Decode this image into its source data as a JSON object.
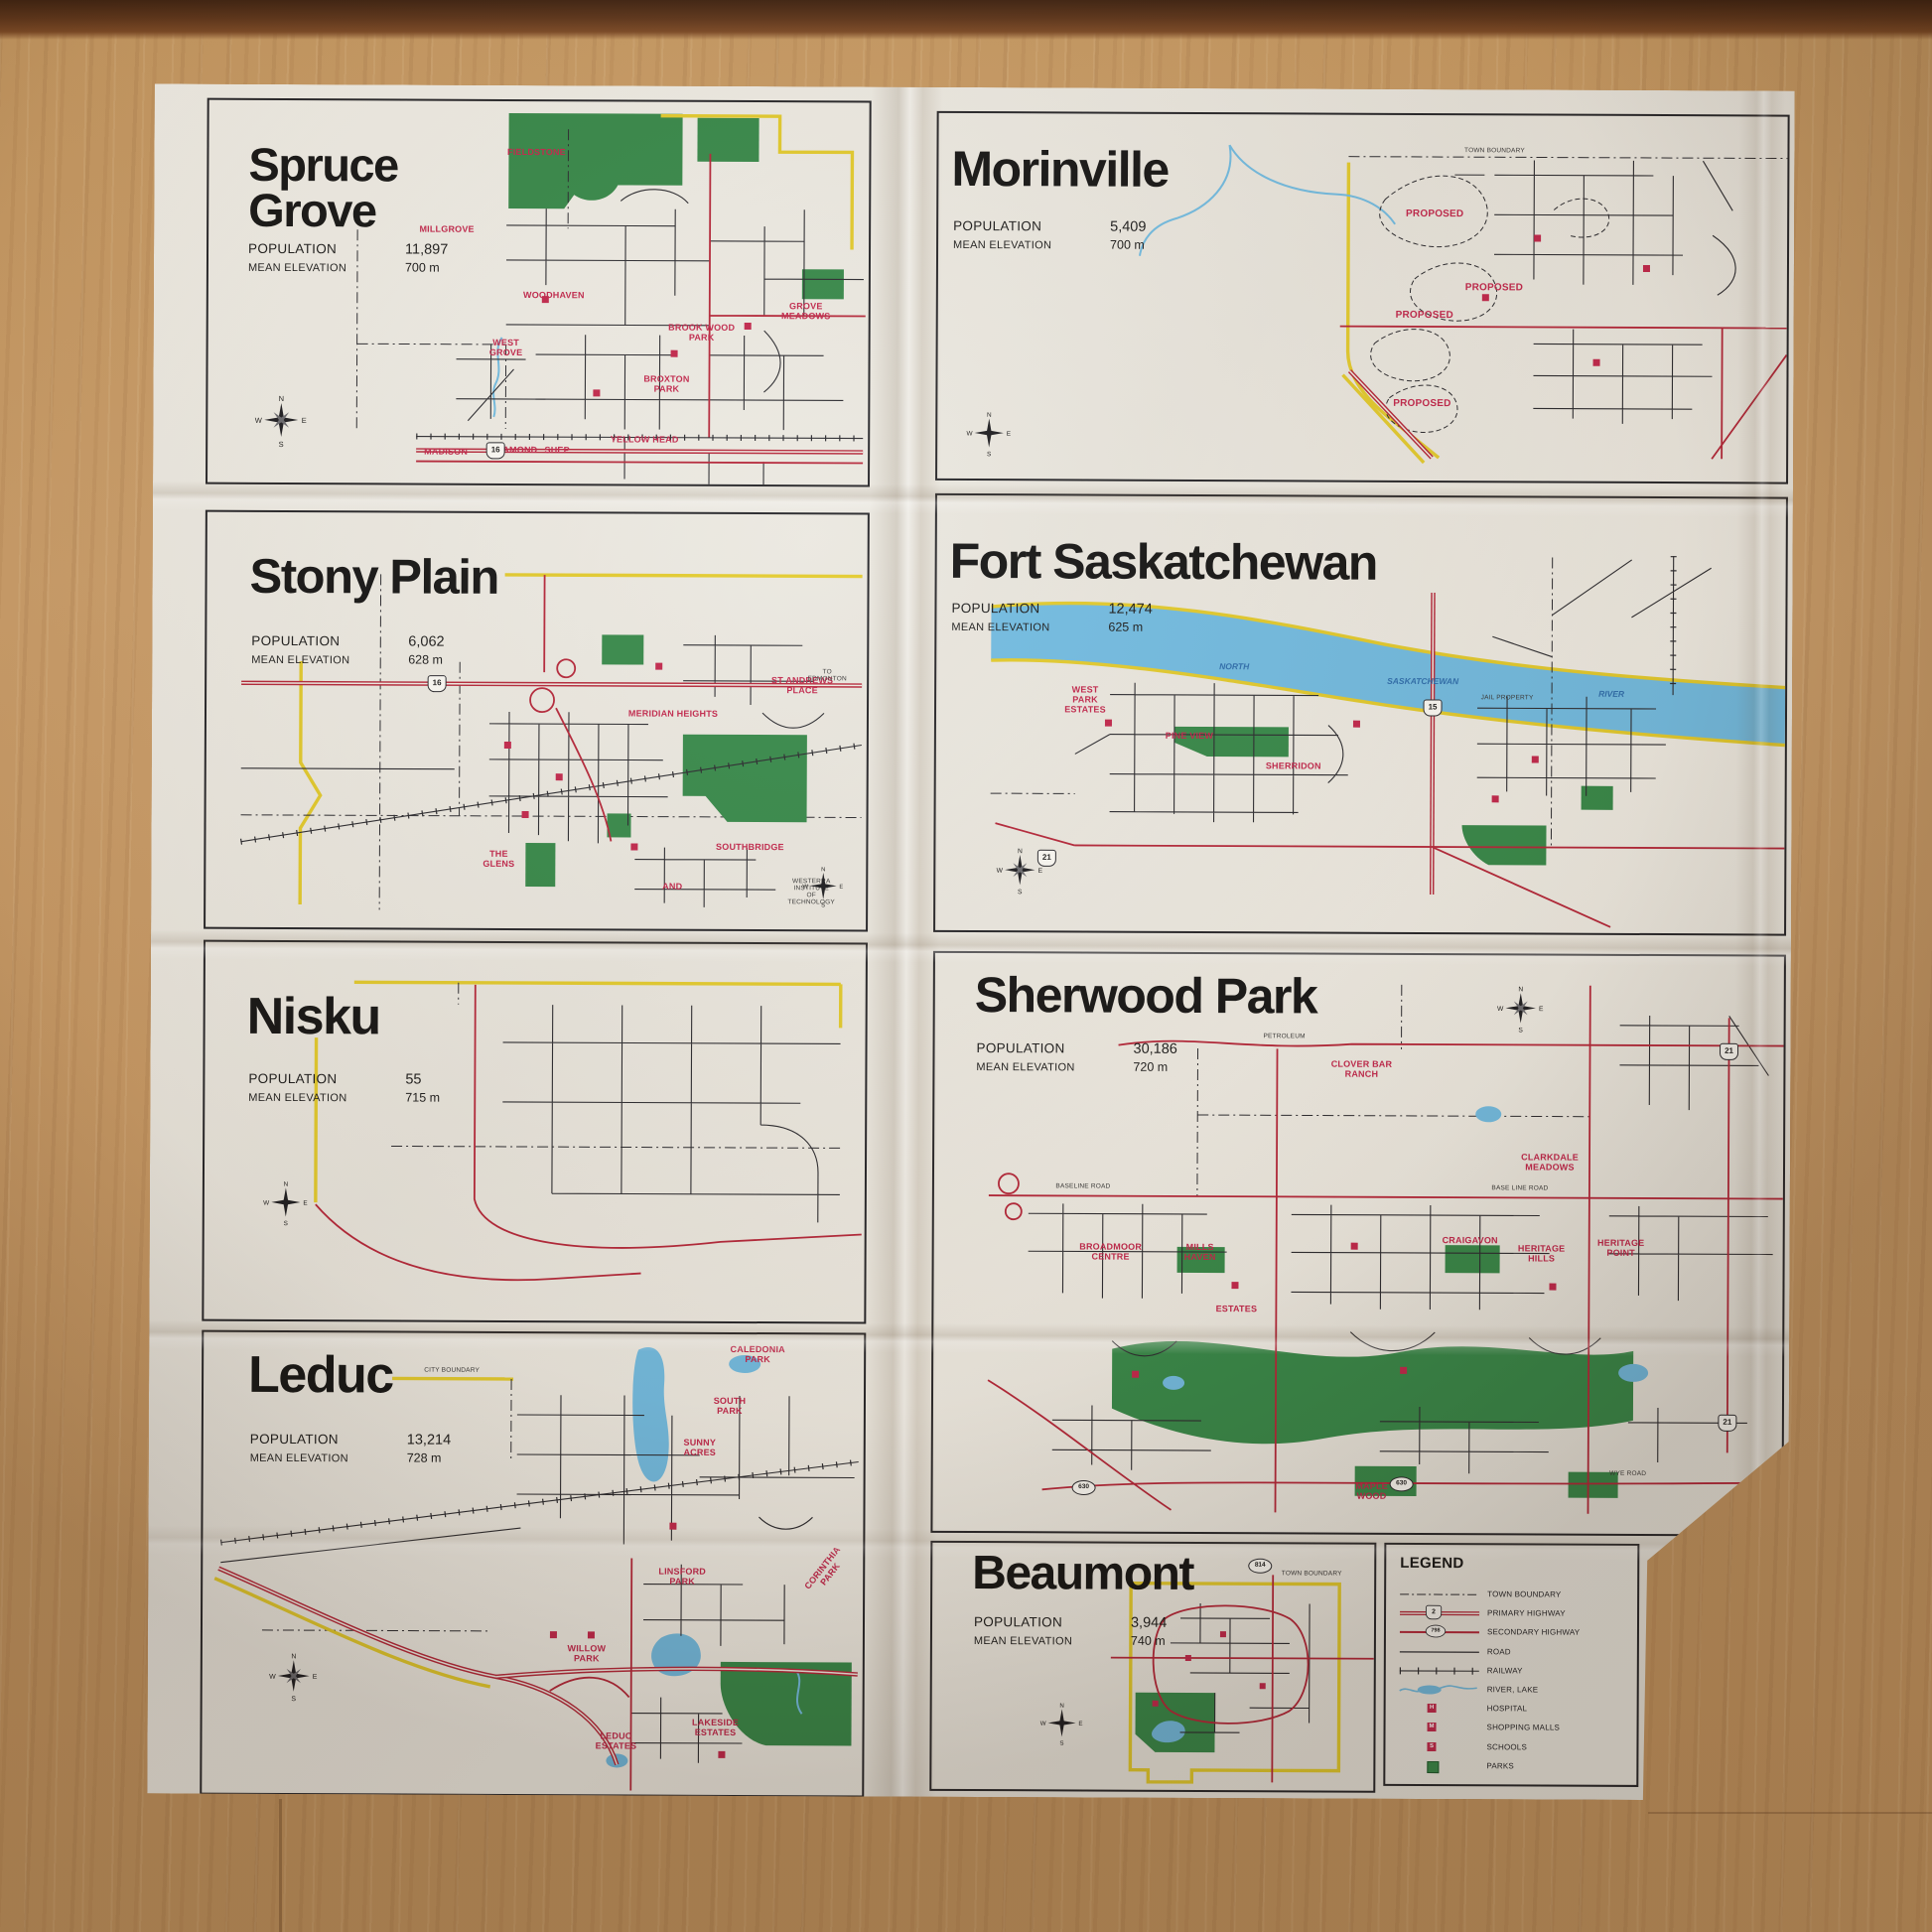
{
  "compass": {
    "n": "N",
    "e": "E",
    "s": "S",
    "w": "W"
  },
  "panels": {
    "spruce_grove": {
      "title": "Spruce Grove",
      "population_label": "POPULATION",
      "population": "11,897",
      "elevation_label": "MEAN ELEVATION",
      "elevation": "700 m",
      "shield": "16",
      "labels": {
        "fieldstone": "FIELDSTONE",
        "millgrove": "MILLGROVE",
        "woodhaven": "WOODHAVEN",
        "west_grove": "WEST\nGROVE",
        "brookwood_park": "BROOK WOOD\nPARK",
        "broxton_park": "BROXTON\nPARK",
        "grove_meadows": "GROVE\nMEADOWS",
        "madison": "MADISON",
        "diamond": "DIAMOND",
        "shep": "SHEP",
        "yellowhead": "YELLOW HEAD"
      }
    },
    "morinville": {
      "title": "Morinville",
      "population_label": "POPULATION",
      "population": "5,409",
      "elevation_label": "MEAN ELEVATION",
      "elevation": "700 m",
      "labels": {
        "proposed1": "PROPOSED",
        "proposed2": "PROPOSED",
        "proposed3": "PROPOSED",
        "proposed4": "PROPOSED",
        "town_boundary": "TOWN BOUNDARY"
      }
    },
    "stony_plain": {
      "title": "Stony Plain",
      "population_label": "POPULATION",
      "population": "6,062",
      "elevation_label": "MEAN ELEVATION",
      "elevation": "628 m",
      "shield": "16",
      "labels": {
        "st_andrews": "ST ANDREWS\nPLACE",
        "meridian_heights": "MERIDIAN HEIGHTS",
        "the_glens": "THE\nGLENS",
        "southbridge": "SOUTHBRIDGE",
        "and": "AND",
        "to_edmonton": "TO EDMONTON",
        "westerra": "WESTERRA INSTITUTE\nOF TECHNOLOGY"
      }
    },
    "fort_saskatchewan": {
      "title": "Fort Saskatchewan",
      "population_label": "POPULATION",
      "population": "12,474",
      "elevation_label": "MEAN ELEVATION",
      "elevation": "625 m",
      "shields": {
        "h15": "15",
        "h21": "21"
      },
      "labels": {
        "west_park": "WEST\nPARK\nESTATES",
        "pine_view": "PINE VIEW",
        "sherridon": "SHERRIDON",
        "river_north": "NORTH",
        "river_sask": "SASKATCHEWAN",
        "river_river": "RIVER",
        "jail": "JAIL PROPERTY"
      }
    },
    "nisku": {
      "title": "Nisku",
      "population_label": "POPULATION",
      "population": "55",
      "elevation_label": "MEAN ELEVATION",
      "elevation": "715 m"
    },
    "sherwood_park": {
      "title": "Sherwood Park",
      "population_label": "POPULATION",
      "population": "30,186",
      "elevation_label": "MEAN ELEVATION",
      "elevation": "720 m",
      "shields": {
        "h21a": "21",
        "h21b": "21",
        "h630a": "630",
        "h630b": "630"
      },
      "labels": {
        "clover_bar": "CLOVER BAR\nRANCH",
        "clarkdale": "CLARKDALE\nMEADOWS",
        "craigavon": "CRAIGAVON",
        "heritage_hills": "HERITAGE\nHILLS",
        "heritage_point": "HERITAGE\nPOINT",
        "broadmoor": "BROADMOOR\nCENTRE",
        "mills_haven": "MILLS\nHAVEN",
        "estates": "ESTATES",
        "maple_wood": "MAPLE\nWOOD",
        "baseline": "BASELINE ROAD",
        "base_line": "BASE LINE ROAD",
        "wye": "WYE ROAD",
        "petroleum": "PETROLEUM"
      }
    },
    "leduc": {
      "title": "Leduc",
      "population_label": "POPULATION",
      "population": "13,214",
      "elevation_label": "MEAN ELEVATION",
      "elevation": "728 m",
      "labels": {
        "caledonia": "CALEDONIA\nPARK",
        "south_park": "SOUTH\nPARK",
        "sunny_acres": "SUNNY\nACRES",
        "linsford": "LINSFORD\nPARK",
        "willow": "WILLOW\nPARK",
        "corinthia": "CORINTHIA PARK",
        "leduc_estates": "LEDUC\nESTATES",
        "lakeside": "LAKESIDE\nESTATES",
        "city_boundary": "CITY BOUNDARY"
      }
    },
    "beaumont": {
      "title": "Beaumont",
      "population_label": "POPULATION",
      "population": "3,944",
      "elevation_label": "MEAN ELEVATION",
      "elevation": "740 m",
      "shield": "814",
      "labels": {
        "town_boundary": "TOWN BOUNDARY"
      }
    }
  },
  "legend": {
    "title": "LEGEND",
    "items": [
      {
        "type": "boundary",
        "label": "TOWN BOUNDARY"
      },
      {
        "type": "primary",
        "label": "PRIMARY HIGHWAY",
        "badge": "2"
      },
      {
        "type": "secondary",
        "label": "SECONDARY HIGHWAY",
        "badge": "798"
      },
      {
        "type": "road",
        "label": "ROAD"
      },
      {
        "type": "railway",
        "label": "RAILWAY"
      },
      {
        "type": "river",
        "label": "RIVER, LAKE"
      },
      {
        "type": "hospital",
        "label": "HOSPITAL",
        "badge": "H"
      },
      {
        "type": "mall",
        "label": "SHOPPING MALLS",
        "badge": "M"
      },
      {
        "type": "school",
        "label": "SCHOOLS",
        "badge": "S"
      },
      {
        "type": "park",
        "label": "PARKS"
      }
    ]
  }
}
